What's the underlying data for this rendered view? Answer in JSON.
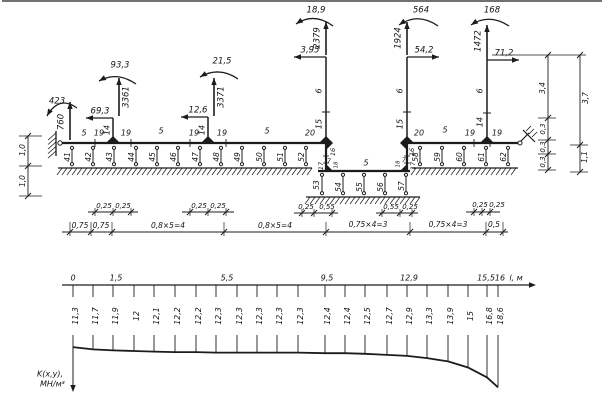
{
  "page": {
    "background": "#ffffff",
    "ink": "#1c1c1c"
  },
  "scheme": {
    "loads": [
      {
        "value": "423",
        "type": "moment",
        "arc": [
          77,
          108,
          59,
          95,
          47,
          116
        ],
        "label_xy": [
          57,
          101
        ]
      },
      {
        "value": "760",
        "type": "force_up",
        "x": 70,
        "y1": 140,
        "y2": 102,
        "label_xy": [
          61,
          122
        ],
        "rot": true
      },
      {
        "value": "93,3",
        "type": "moment",
        "arc": [
          136,
          84,
          117,
          71,
          99,
          81
        ],
        "label_xy": [
          120,
          65
        ]
      },
      {
        "value": "3361",
        "type": "force_up",
        "x": 119,
        "y1": 116,
        "y2": 78,
        "label_xy": [
          126,
          97
        ],
        "rot": true
      },
      {
        "value": "69,3",
        "type": "force_left",
        "y": 118,
        "x1": 113,
        "x2": 86,
        "label_xy": [
          100,
          111
        ]
      },
      {
        "value": "21,5",
        "type": "moment",
        "arc": [
          238,
          79,
          219,
          66,
          200,
          77
        ],
        "label_xy": [
          222,
          61
        ]
      },
      {
        "value": "3371",
        "type": "force_up",
        "x": 214,
        "y1": 116,
        "y2": 78,
        "label_xy": [
          221,
          97
        ],
        "rot": true
      },
      {
        "value": "12,6",
        "type": "force_left",
        "y": 117,
        "x1": 208,
        "x2": 181,
        "label_xy": [
          198,
          110
        ]
      },
      {
        "value": "18,9",
        "type": "moment",
        "arc": [
          333,
          26,
          314,
          12,
          296,
          24
        ],
        "label_xy": [
          316,
          10
        ]
      },
      {
        "value": "2379",
        "type": "force_up",
        "x": 326,
        "y1": 55,
        "y2": 22,
        "label_xy": [
          317,
          38
        ],
        "rot": true
      },
      {
        "value": "3,95",
        "type": "force_left",
        "y": 57,
        "x1": 326,
        "x2": 294,
        "label_xy": [
          310,
          50
        ]
      },
      {
        "value": "564",
        "type": "moment",
        "arc": [
          438,
          26,
          418,
          12,
          399,
          25
        ],
        "label_xy": [
          421,
          10
        ]
      },
      {
        "value": "1924",
        "type": "force_up",
        "x": 407,
        "y1": 55,
        "y2": 22,
        "label_xy": [
          398,
          38
        ],
        "rot": true
      },
      {
        "value": "54,2",
        "type": "force_right",
        "y": 57,
        "x1": 407,
        "x2": 439,
        "label_xy": [
          424,
          50
        ]
      },
      {
        "value": "168",
        "type": "moment",
        "arc": [
          509,
          26,
          489,
          13,
          471,
          25
        ],
        "label_xy": [
          492,
          10
        ]
      },
      {
        "value": "1472",
        "type": "force_up",
        "x": 487,
        "y1": 58,
        "y2": 25,
        "label_xy": [
          478,
          41
        ],
        "rot": true
      },
      {
        "value": "71,2",
        "type": "force_right",
        "y": 60,
        "x1": 487,
        "x2": 519,
        "label_xy": [
          504,
          53
        ]
      }
    ],
    "labels": [
      {
        "t": "5",
        "x": 84,
        "y": 133
      },
      {
        "t": "19",
        "x": 99,
        "y": 133
      },
      {
        "t": "14",
        "x": 107,
        "y": 130,
        "r": 1
      },
      {
        "t": "19",
        "x": 126,
        "y": 133
      },
      {
        "t": "5",
        "x": 161,
        "y": 131
      },
      {
        "t": "19",
        "x": 194,
        "y": 133
      },
      {
        "t": "14",
        "x": 202,
        "y": 130,
        "r": 1
      },
      {
        "t": "19",
        "x": 222,
        "y": 133
      },
      {
        "t": "5",
        "x": 267,
        "y": 131
      },
      {
        "t": "20",
        "x": 310,
        "y": 133
      },
      {
        "t": "20",
        "x": 419,
        "y": 133
      },
      {
        "t": "5",
        "x": 445,
        "y": 130
      },
      {
        "t": "19",
        "x": 470,
        "y": 133
      },
      {
        "t": "14",
        "x": 480,
        "y": 122,
        "r": 1
      },
      {
        "t": "19",
        "x": 497,
        "y": 133
      },
      {
        "t": "6",
        "x": 319,
        "y": 91,
        "r": 1
      },
      {
        "t": "15",
        "x": 319,
        "y": 124,
        "r": 1
      },
      {
        "t": "6",
        "x": 400,
        "y": 91,
        "r": 1
      },
      {
        "t": "15",
        "x": 400,
        "y": 124,
        "r": 1
      },
      {
        "t": "6",
        "x": 480,
        "y": 91,
        "r": 1
      },
      {
        "t": "16",
        "x": 333,
        "y": 152,
        "r": 1,
        "s": 6.5
      },
      {
        "t": "7",
        "x": 329,
        "y": 161,
        "s": 6.5
      },
      {
        "t": "18",
        "x": 336,
        "y": 165,
        "r": 1,
        "s": 5.5
      },
      {
        "t": "17",
        "x": 321,
        "y": 166,
        "r": 1,
        "s": 6.5
      },
      {
        "t": "16",
        "x": 412,
        "y": 152,
        "r": 1,
        "s": 6.5
      },
      {
        "t": "7",
        "x": 404,
        "y": 160,
        "s": 6.5
      },
      {
        "t": "18",
        "x": 398,
        "y": 164,
        "r": 1,
        "s": 5.5
      },
      {
        "t": "17",
        "x": 413,
        "y": 166,
        "r": 1,
        "s": 6.5
      },
      {
        "t": "5",
        "x": 366,
        "y": 163
      },
      {
        "t": "41",
        "x": 68,
        "y": 157,
        "r": 1,
        "s": 7.5
      },
      {
        "t": "42",
        "x": 89,
        "y": 157,
        "r": 1,
        "s": 7.5
      },
      {
        "t": "43",
        "x": 110,
        "y": 157,
        "r": 1,
        "s": 7.5
      },
      {
        "t": "44",
        "x": 132,
        "y": 157,
        "r": 1,
        "s": 7.5
      },
      {
        "t": "45",
        "x": 153,
        "y": 157,
        "r": 1,
        "s": 7.5
      },
      {
        "t": "46",
        "x": 174,
        "y": 157,
        "r": 1,
        "s": 7.5
      },
      {
        "t": "47",
        "x": 196,
        "y": 157,
        "r": 1,
        "s": 7.5
      },
      {
        "t": "48",
        "x": 217,
        "y": 157,
        "r": 1,
        "s": 7.5
      },
      {
        "t": "49",
        "x": 238,
        "y": 157,
        "r": 1,
        "s": 7.5
      },
      {
        "t": "50",
        "x": 260,
        "y": 157,
        "r": 1,
        "s": 7.5
      },
      {
        "t": "51",
        "x": 281,
        "y": 157,
        "r": 1,
        "s": 7.5
      },
      {
        "t": "52",
        "x": 302,
        "y": 157,
        "r": 1,
        "s": 7.5
      },
      {
        "t": "53",
        "x": 317,
        "y": 185,
        "r": 1,
        "s": 7.5
      },
      {
        "t": "54",
        "x": 339,
        "y": 187,
        "r": 1,
        "s": 7.5
      },
      {
        "t": "55",
        "x": 360,
        "y": 187,
        "r": 1,
        "s": 7.5
      },
      {
        "t": "56",
        "x": 381,
        "y": 187,
        "r": 1,
        "s": 7.5
      },
      {
        "t": "57",
        "x": 402,
        "y": 186,
        "r": 1,
        "s": 7.5
      },
      {
        "t": "58",
        "x": 416,
        "y": 157,
        "r": 1,
        "s": 7.5
      },
      {
        "t": "59",
        "x": 438,
        "y": 157,
        "r": 1,
        "s": 7.5
      },
      {
        "t": "60",
        "x": 460,
        "y": 157,
        "r": 1,
        "s": 7.5
      },
      {
        "t": "61",
        "x": 482,
        "y": 157,
        "r": 1,
        "s": 7.5
      },
      {
        "t": "62",
        "x": 504,
        "y": 157,
        "r": 1,
        "s": 7.5
      },
      {
        "t": "0,25",
        "x": 104,
        "y": 206,
        "s": 7
      },
      {
        "t": "0,25",
        "x": 123,
        "y": 206,
        "s": 7
      },
      {
        "t": "0,25",
        "x": 199,
        "y": 206,
        "s": 7
      },
      {
        "t": "0,25",
        "x": 218,
        "y": 206,
        "s": 7
      },
      {
        "t": "0,25",
        "x": 306,
        "y": 207,
        "s": 7
      },
      {
        "t": "0,55",
        "x": 327,
        "y": 207,
        "s": 7
      },
      {
        "t": "0,55",
        "x": 391,
        "y": 207,
        "s": 7
      },
      {
        "t": "0,25",
        "x": 410,
        "y": 207,
        "s": 7
      },
      {
        "t": "0,25",
        "x": 480,
        "y": 205,
        "s": 7
      },
      {
        "t": "0,25",
        "x": 497,
        "y": 205,
        "s": 7
      },
      {
        "t": "0,75",
        "x": 80,
        "y": 226,
        "s": 7.5
      },
      {
        "t": "0,75",
        "x": 101,
        "y": 226,
        "s": 7.5
      },
      {
        "t": "0,8×5=4",
        "x": 168,
        "y": 226,
        "s": 7.5
      },
      {
        "t": "0,8×5=4",
        "x": 275,
        "y": 226,
        "s": 7.5
      },
      {
        "t": "0,75×4=3",
        "x": 368,
        "y": 225,
        "s": 7.5
      },
      {
        "t": "0,75×4=3",
        "x": 448,
        "y": 225,
        "s": 7.5
      },
      {
        "t": "0,5",
        "x": 494,
        "y": 225,
        "s": 7.5
      },
      {
        "t": "3,4",
        "x": 543,
        "y": 88,
        "r": 1,
        "s": 7.5
      },
      {
        "t": "0,3",
        "x": 543,
        "y": 129,
        "r": 1,
        "s": 7
      },
      {
        "t": "0,3",
        "x": 543,
        "y": 147,
        "r": 1,
        "s": 7
      },
      {
        "t": "0,3",
        "x": 543,
        "y": 162,
        "r": 1,
        "s": 7
      },
      {
        "t": "3,7",
        "x": 586,
        "y": 98,
        "r": 1,
        "s": 7.5
      },
      {
        "t": "1,1",
        "x": 585,
        "y": 157,
        "r": 1,
        "s": 7.5
      },
      {
        "t": "1,0",
        "x": 23,
        "y": 150,
        "r": 1,
        "s": 7.5
      },
      {
        "t": "1,0",
        "x": 23,
        "y": 181,
        "r": 1,
        "s": 7.5
      }
    ]
  },
  "chart_data": {
    "type": "line",
    "title": "subgrade modulus distribution along foundation",
    "xlabel": "l, м",
    "ylabel": "K(x,y), МН/м³",
    "ylabel_lines": [
      "K(x,y),",
      "МН/м³"
    ],
    "x_m": [
      0,
      0.75,
      1.5,
      2.3,
      3.1,
      3.9,
      4.7,
      5.5,
      6.3,
      7.1,
      7.9,
      8.7,
      9.5,
      10.3,
      11.1,
      11.9,
      12.5,
      12.9,
      13.7,
      14.5,
      15.5,
      16
    ],
    "x_px": [
      73,
      93,
      113,
      134,
      154,
      175,
      196,
      216,
      237,
      257,
      277,
      298,
      325,
      345,
      365,
      387,
      407,
      427,
      448,
      468,
      487,
      498
    ],
    "values": [
      11.3,
      11.7,
      11.9,
      12,
      12.1,
      12.2,
      12.2,
      12.3,
      12.3,
      12.3,
      12.3,
      12.3,
      12.4,
      12.4,
      12.5,
      12.7,
      12.9,
      13.3,
      13.9,
      15,
      16.8,
      18.6
    ],
    "x_axis_labels": [
      {
        "t": "0",
        "x": 73
      },
      {
        "t": "1,5",
        "x": 116
      },
      {
        "t": "5,5",
        "x": 227
      },
      {
        "t": "9,5",
        "x": 327
      },
      {
        "t": "12,9",
        "x": 409
      },
      {
        "t": "15,5",
        "x": 486
      },
      {
        "t": "16",
        "x": 500
      },
      {
        "t": "l, м",
        "x": 516
      }
    ],
    "xlim": [
      0,
      16
    ],
    "grid": false,
    "axis_direction": "K increases downward"
  }
}
